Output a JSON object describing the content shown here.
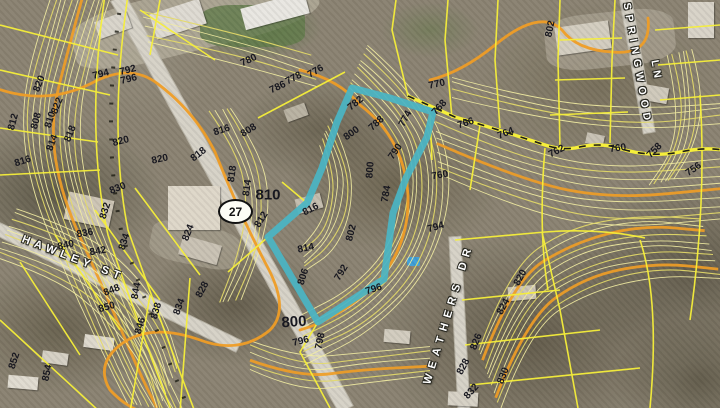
{
  "map": {
    "route_shield": {
      "number": "27"
    },
    "roads": {
      "hawley": {
        "label": "HAWLEY ST"
      },
      "weathers": {
        "label": "WEATHERS DR"
      },
      "springwood": {
        "label": "SPRINGWOOD"
      },
      "springwood2": {
        "label": "LN"
      }
    },
    "parcel_highlight": {
      "color": "#4ab5c4",
      "points": "352,88 390,98 433,112 427,137 406,178 393,213 388,250 384,279 318,322 268,237 307,203 322,168 337,122"
    },
    "colors": {
      "contour_minor": "#f2eda2",
      "contour_mid": "#e4da68",
      "contour_index": "#ef9d26",
      "parcel_line": "#f6ef3a"
    },
    "contour_labels": [
      {
        "t": "794",
        "x": 101,
        "y": 75,
        "r": -14
      },
      {
        "t": "792",
        "x": 128,
        "y": 71,
        "r": -14
      },
      {
        "t": "796",
        "x": 129,
        "y": 80,
        "r": -14
      },
      {
        "t": "780",
        "x": 249,
        "y": 61,
        "r": -25
      },
      {
        "t": "778",
        "x": 294,
        "y": 79,
        "r": -28
      },
      {
        "t": "776",
        "x": 316,
        "y": 72,
        "r": -30
      },
      {
        "t": "786",
        "x": 278,
        "y": 88,
        "r": -25
      },
      {
        "t": "770",
        "x": 437,
        "y": 85,
        "r": -12
      },
      {
        "t": "802",
        "x": 551,
        "y": 29,
        "r": -78
      },
      {
        "t": "782",
        "x": 356,
        "y": 104,
        "r": -38
      },
      {
        "t": "788",
        "x": 377,
        "y": 124,
        "r": -42
      },
      {
        "t": "800",
        "x": 352,
        "y": 134,
        "r": -36
      },
      {
        "t": "790",
        "x": 396,
        "y": 152,
        "r": -55
      },
      {
        "t": "800",
        "x": 371,
        "y": 170,
        "r": -86
      },
      {
        "t": "784",
        "x": 387,
        "y": 194,
        "r": -80
      },
      {
        "t": "774",
        "x": 406,
        "y": 119,
        "r": -62
      },
      {
        "t": "768",
        "x": 440,
        "y": 108,
        "r": -48
      },
      {
        "t": "766",
        "x": 466,
        "y": 124,
        "r": -18
      },
      {
        "t": "764",
        "x": 506,
        "y": 134,
        "r": -22
      },
      {
        "t": "762",
        "x": 557,
        "y": 152,
        "r": -28
      },
      {
        "t": "760",
        "x": 618,
        "y": 149,
        "r": -8
      },
      {
        "t": "758",
        "x": 655,
        "y": 151,
        "r": -45
      },
      {
        "t": "756",
        "x": 694,
        "y": 170,
        "r": -35
      },
      {
        "t": "760",
        "x": 440,
        "y": 176,
        "r": -10
      },
      {
        "t": "820",
        "x": 40,
        "y": 84,
        "r": -68
      },
      {
        "t": "822",
        "x": 58,
        "y": 106,
        "r": -68
      },
      {
        "t": "810",
        "x": 51,
        "y": 120,
        "r": -72
      },
      {
        "t": "808",
        "x": 37,
        "y": 121,
        "r": -75
      },
      {
        "t": "812",
        "x": 14,
        "y": 122,
        "r": -75
      },
      {
        "t": "818",
        "x": 71,
        "y": 134,
        "r": -68
      },
      {
        "t": "814",
        "x": 53,
        "y": 143,
        "r": -70
      },
      {
        "t": "816",
        "x": 23,
        "y": 162,
        "r": -18
      },
      {
        "t": "820",
        "x": 121,
        "y": 142,
        "r": -15
      },
      {
        "t": "820",
        "x": 160,
        "y": 160,
        "r": -12
      },
      {
        "t": "830",
        "x": 118,
        "y": 189,
        "r": -22
      },
      {
        "t": "816",
        "x": 222,
        "y": 131,
        "r": -18
      },
      {
        "t": "808",
        "x": 249,
        "y": 131,
        "r": -32
      },
      {
        "t": "818",
        "x": 199,
        "y": 155,
        "r": -38
      },
      {
        "t": "818",
        "x": 233,
        "y": 174,
        "r": -82
      },
      {
        "t": "814",
        "x": 248,
        "y": 188,
        "r": -82
      },
      {
        "t": "810",
        "x": 268,
        "y": 195,
        "r": 0,
        "s": 15
      },
      {
        "t": "812",
        "x": 262,
        "y": 220,
        "r": -58
      },
      {
        "t": "824",
        "x": 189,
        "y": 233,
        "r": -68
      },
      {
        "t": "816",
        "x": 311,
        "y": 210,
        "r": -28
      },
      {
        "t": "814",
        "x": 306,
        "y": 249,
        "r": -12
      },
      {
        "t": "802",
        "x": 352,
        "y": 233,
        "r": -76
      },
      {
        "t": "806",
        "x": 304,
        "y": 277,
        "r": -72
      },
      {
        "t": "792",
        "x": 342,
        "y": 273,
        "r": -58
      },
      {
        "t": "796",
        "x": 374,
        "y": 290,
        "r": -18
      },
      {
        "t": "800",
        "x": 294,
        "y": 322,
        "r": -4,
        "s": 15
      },
      {
        "t": "796",
        "x": 301,
        "y": 342,
        "r": -14
      },
      {
        "t": "798",
        "x": 321,
        "y": 341,
        "r": -78
      },
      {
        "t": "836",
        "x": 85,
        "y": 234,
        "r": -10
      },
      {
        "t": "840",
        "x": 66,
        "y": 246,
        "r": -12
      },
      {
        "t": "842",
        "x": 98,
        "y": 252,
        "r": -10
      },
      {
        "t": "832",
        "x": 106,
        "y": 211,
        "r": -72
      },
      {
        "t": "834",
        "x": 125,
        "y": 242,
        "r": -72
      },
      {
        "t": "828",
        "x": 203,
        "y": 290,
        "r": -62
      },
      {
        "t": "834",
        "x": 180,
        "y": 307,
        "r": -70
      },
      {
        "t": "838",
        "x": 157,
        "y": 311,
        "r": -74
      },
      {
        "t": "844",
        "x": 137,
        "y": 291,
        "r": -80
      },
      {
        "t": "848",
        "x": 112,
        "y": 291,
        "r": -22
      },
      {
        "t": "850",
        "x": 107,
        "y": 308,
        "r": -16
      },
      {
        "t": "846",
        "x": 141,
        "y": 326,
        "r": -74
      },
      {
        "t": "852",
        "x": 15,
        "y": 361,
        "r": -72
      },
      {
        "t": "854",
        "x": 48,
        "y": 373,
        "r": -78
      },
      {
        "t": "794",
        "x": 436,
        "y": 228,
        "r": -16
      },
      {
        "t": "820",
        "x": 521,
        "y": 278,
        "r": -62
      },
      {
        "t": "824",
        "x": 504,
        "y": 307,
        "r": -62
      },
      {
        "t": "826",
        "x": 477,
        "y": 342,
        "r": -68
      },
      {
        "t": "828",
        "x": 464,
        "y": 367,
        "r": -62
      },
      {
        "t": "832",
        "x": 472,
        "y": 392,
        "r": -48
      },
      {
        "t": "830",
        "x": 504,
        "y": 376,
        "r": -68
      }
    ]
  }
}
